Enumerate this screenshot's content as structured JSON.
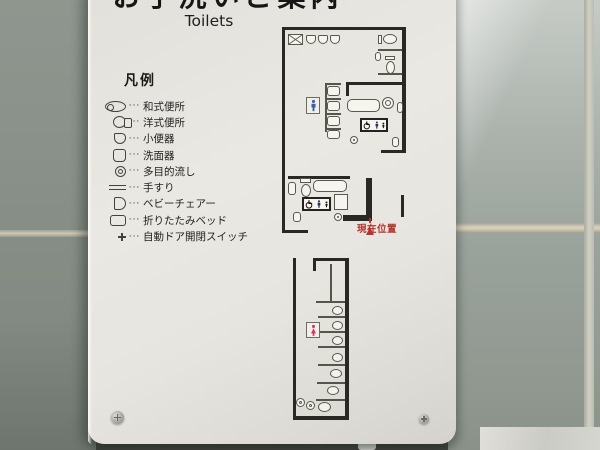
{
  "sign": {
    "title": "お手洗いご案内",
    "subtitle": "Toilets"
  },
  "legend": {
    "heading": "凡例",
    "separator": "···",
    "items": [
      {
        "icon": "squat-toilet",
        "label": "和式便所"
      },
      {
        "icon": "western-toilet",
        "label": "洋式便所"
      },
      {
        "icon": "urinal",
        "label": "小便器"
      },
      {
        "icon": "washbasin",
        "label": "洗面器"
      },
      {
        "icon": "multipurpose-sink",
        "label": "多目的流し"
      },
      {
        "icon": "handrail",
        "label": "手すり"
      },
      {
        "icon": "baby-chair",
        "label": "ベビーチェアー"
      },
      {
        "icon": "folding-bed",
        "label": "折りたたみベッド"
      },
      {
        "icon": "auto-door-switch",
        "label": "自動ドア開閉スイッチ"
      }
    ]
  },
  "floorplan": {
    "current_location_label": "現在位置",
    "mens_area_icon": "man-pictogram",
    "womens_area_icon": "woman-pictogram",
    "accessible_sign_icons": [
      "wheelchair",
      "person",
      "baby"
    ],
    "colors": {
      "wall": "#2a2824",
      "current_location_red": "#b5342c",
      "men_blue": "#3a5fa8",
      "women_pink": "#d2356a"
    }
  }
}
